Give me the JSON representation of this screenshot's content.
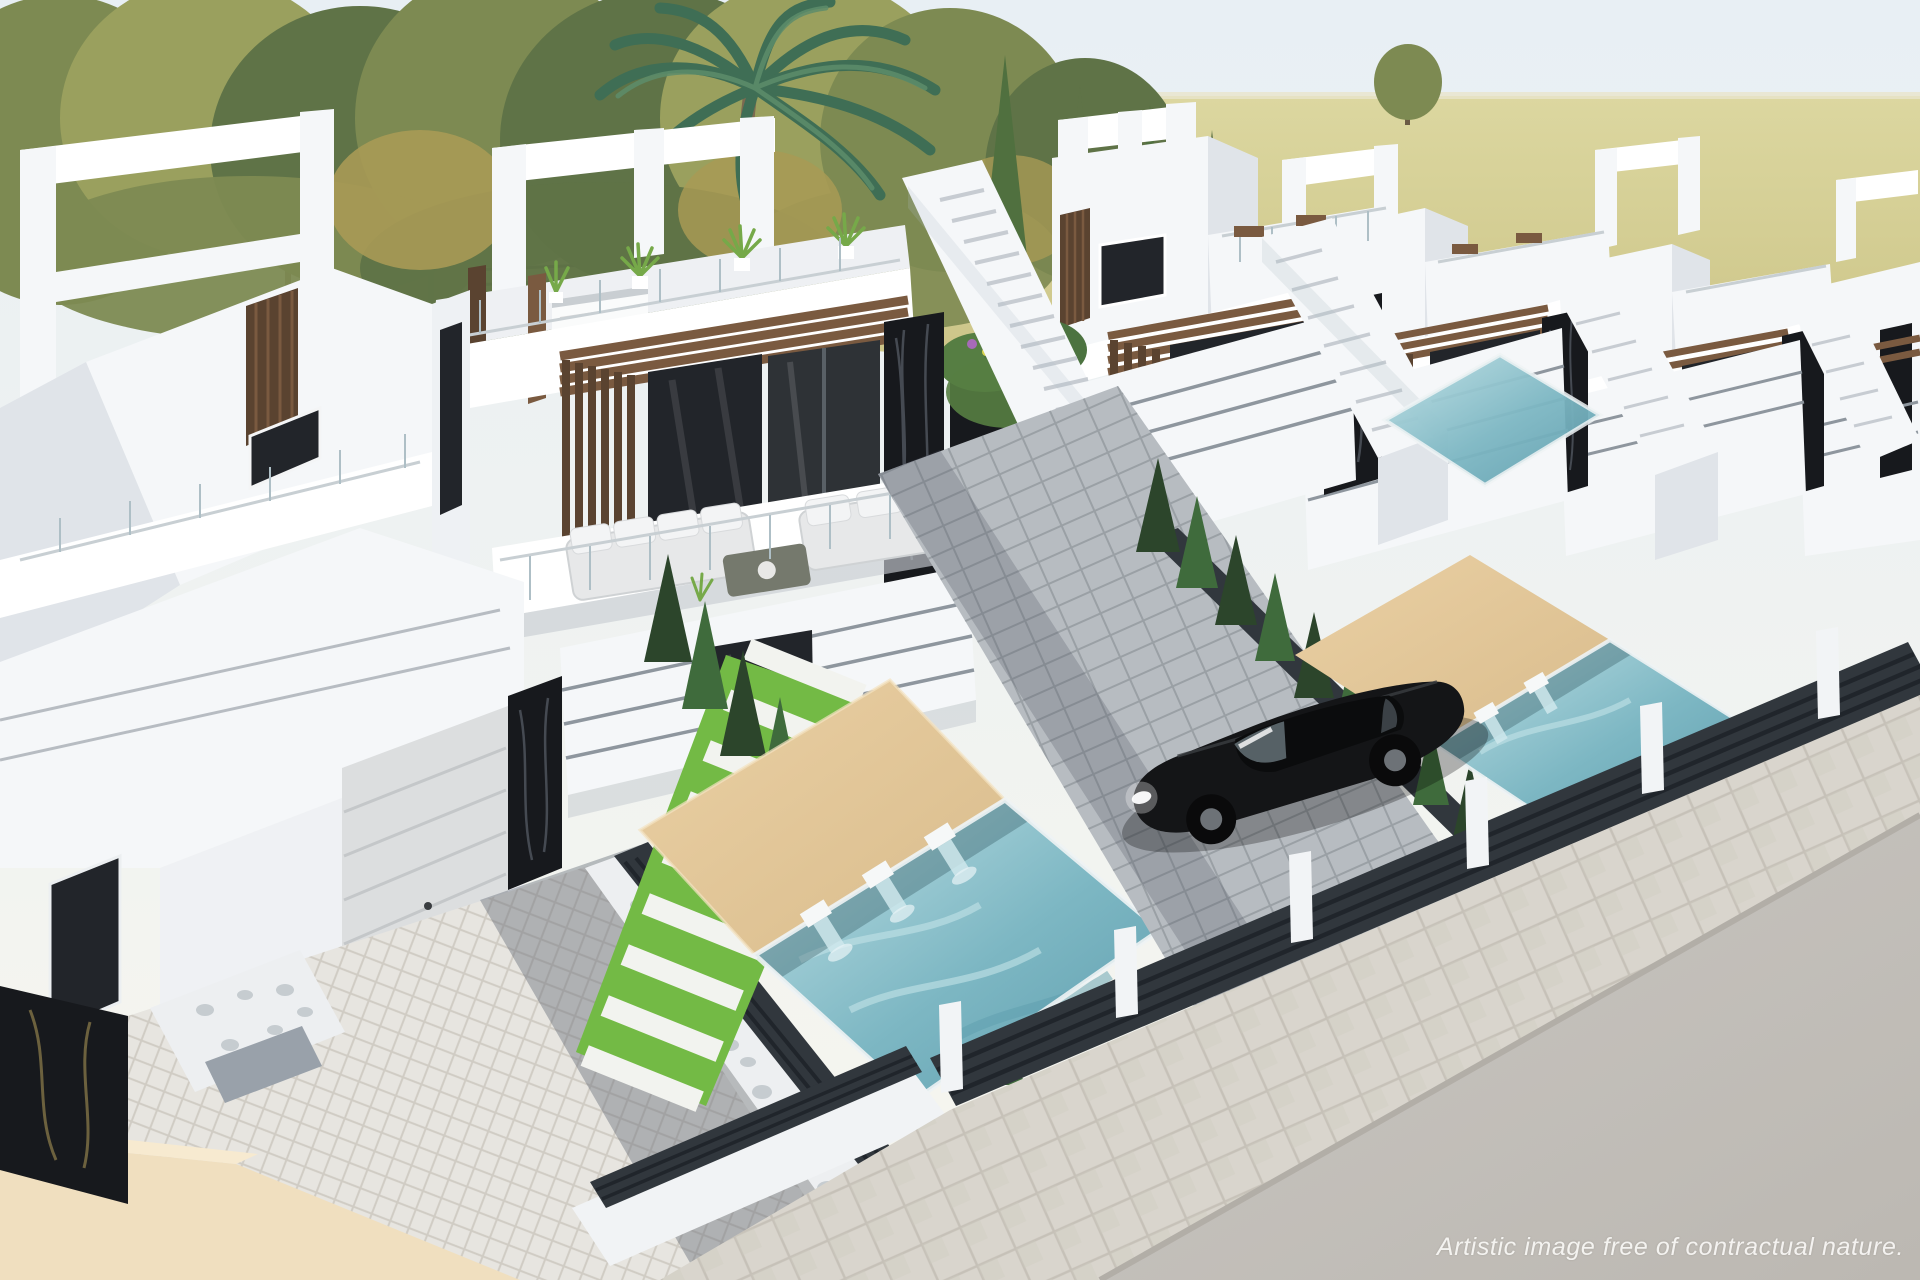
{
  "scene": {
    "description": "Aerial 3D architectural render of a row of modern white two-storey villas with rooftop terraces, wood pergolas, black marble pillars, private pools with waterfall spouts, beige sun decks, cypress hedges, a parked black car, paved driveways, a sidewalk and a road",
    "caption": "Artistic image free of contractual nature."
  },
  "colors": {
    "sky_top": "#e8eff4",
    "sky_low": "#f7f6ee",
    "field": "#c9c183",
    "field_light": "#dcd7a0",
    "horizon": "#e9e5cc",
    "meadow": "#a6b077",
    "path": "#cfc8b4",
    "tree_dark": "#5f7347",
    "tree_mid": "#7d8a52",
    "tree_light": "#9aa05e",
    "tree_autumn": "#a89a55",
    "conifer": "#50703f",
    "trunk": "#6b5b45",
    "palm_leaf": "#3f6e55",
    "palm_leaf_light": "#5d8d6b",
    "palm_trunk": "#7c6a50",
    "villa_white": "#f5f7f9",
    "villa_bright": "#ffffff",
    "villa_shade": "#e0e4e9",
    "villa_deep": "#c7ccd2",
    "groove": "#8e969e",
    "wood": "#7a5a40",
    "wood_dark": "#5a4330",
    "marble": "#17191d",
    "marble_vein": "#5a5f6a",
    "marble_gold": "#8a7a4a",
    "glass_dark": "#22252a",
    "glass_mid": "#2e3236",
    "glass_streak": "#aebfc6",
    "balustrade": "#c8cfd3",
    "pool": "#7db7c3",
    "pool_deep": "#5e9dad",
    "pool_light": "#bfe0e5",
    "deck": "#ead0a4",
    "deck_shade": "#d9bc8c",
    "grass": "#7cc24a",
    "grass_dark": "#57a437",
    "gravel": "#edeff1",
    "pebble": "#c6ccd0",
    "herringbone": "#e7e5e0",
    "herringbone_line": "#d0ccc4",
    "pave_shadow": "#626a75",
    "court": "#b7bcc1",
    "court_line": "#9aa0a5",
    "hedge": "#2c452b",
    "hedge_light": "#3f6b3c",
    "fence": "#31373d",
    "fence_line": "#1a1e24",
    "sidewalk": "#d9d5cd",
    "sidewalk_line": "#c6c1b8",
    "road": "#c9c6c1",
    "road_dark": "#bcb8b2",
    "curb": "#b2aea7",
    "car_body": "#141517",
    "car_roof": "#0b0c0d",
    "car_window": "#5e6a70",
    "car_rim": "#6d7277",
    "sofa": "#e7e8e9",
    "sofa_light": "#f3f4f5",
    "flower_purple": "#a76ab8",
    "flower_pink": "#c2556e",
    "flower_yellow": "#d8d24e",
    "caption": "#f7f6f4"
  }
}
